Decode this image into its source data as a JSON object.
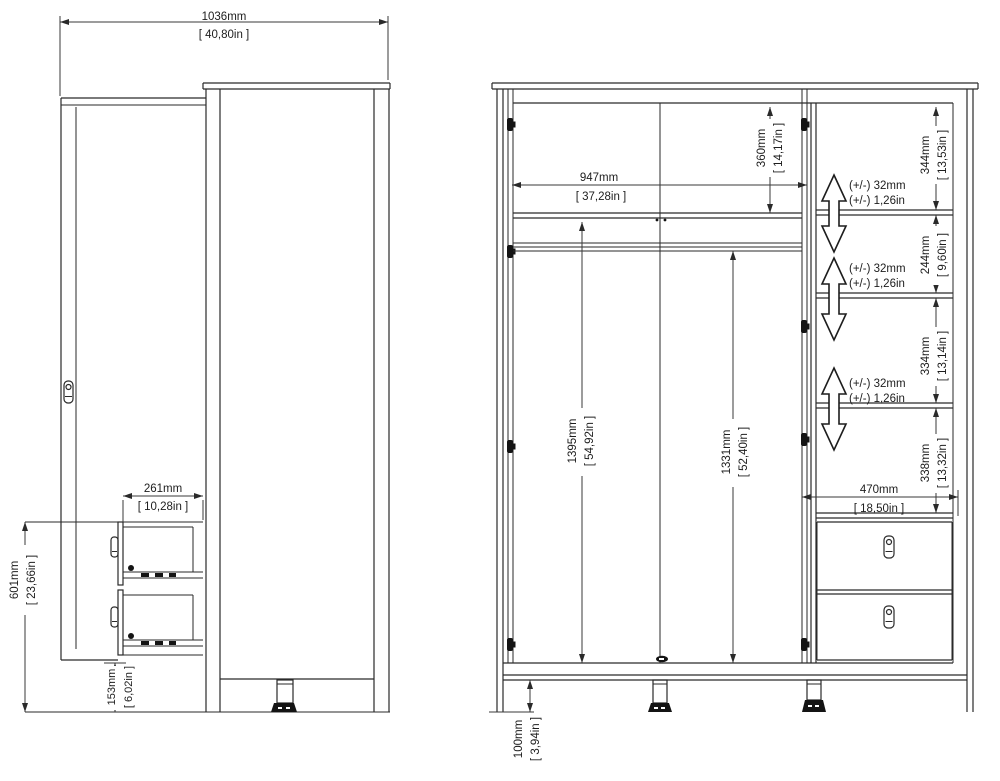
{
  "drawing_type": "wardrobe-technical-dimension-diagram",
  "units_style": {
    "primary": "mm",
    "secondary": "inches-in-brackets",
    "decimal_separator": ","
  },
  "side_view": {
    "total_depth_door_open": {
      "mm": "1036mm",
      "in": "[ 40,80in ]"
    },
    "drawer_extension": {
      "mm": "261mm",
      "in": "[ 10,28in ]"
    },
    "drawer_unit_height": {
      "mm": "601mm",
      "in": "[ 23,66in ]"
    },
    "base_clearance": {
      "mm": "153mm",
      "in": "[ 6,02in ]"
    }
  },
  "front_view": {
    "interior_width": {
      "mm": "947mm",
      "in": "[ 37,28in ]"
    },
    "top_section_height": {
      "mm": "360mm",
      "in": "[ 14,17in ]"
    },
    "interior_height_shelf_to_base": {
      "mm": "1395mm",
      "in": "[ 54,92in ]"
    },
    "rail_to_base_height": {
      "mm": "1331mm",
      "in": "[ 52,40in ]"
    },
    "shelf_section_1": {
      "mm": "344mm",
      "in": "[ 13,53in ]"
    },
    "shelf_section_2": {
      "mm": "244mm",
      "in": "[ 9,60in ]"
    },
    "shelf_section_3": {
      "mm": "334mm",
      "in": "[ 13,14in ]"
    },
    "shelf_section_4": {
      "mm": "338mm",
      "in": "[ 13,32in ]"
    },
    "column_width": {
      "mm": "470mm",
      "in": "[ 18,50in ]"
    },
    "leg_height": {
      "mm": "100mm",
      "in": "[ 3,94in ]"
    },
    "shelf_adjustability": {
      "mm": "(+/-) 32mm",
      "in": "(+/-) 1,26in"
    }
  },
  "colors": {
    "line": "#2a2a2a",
    "background": "#ffffff"
  }
}
